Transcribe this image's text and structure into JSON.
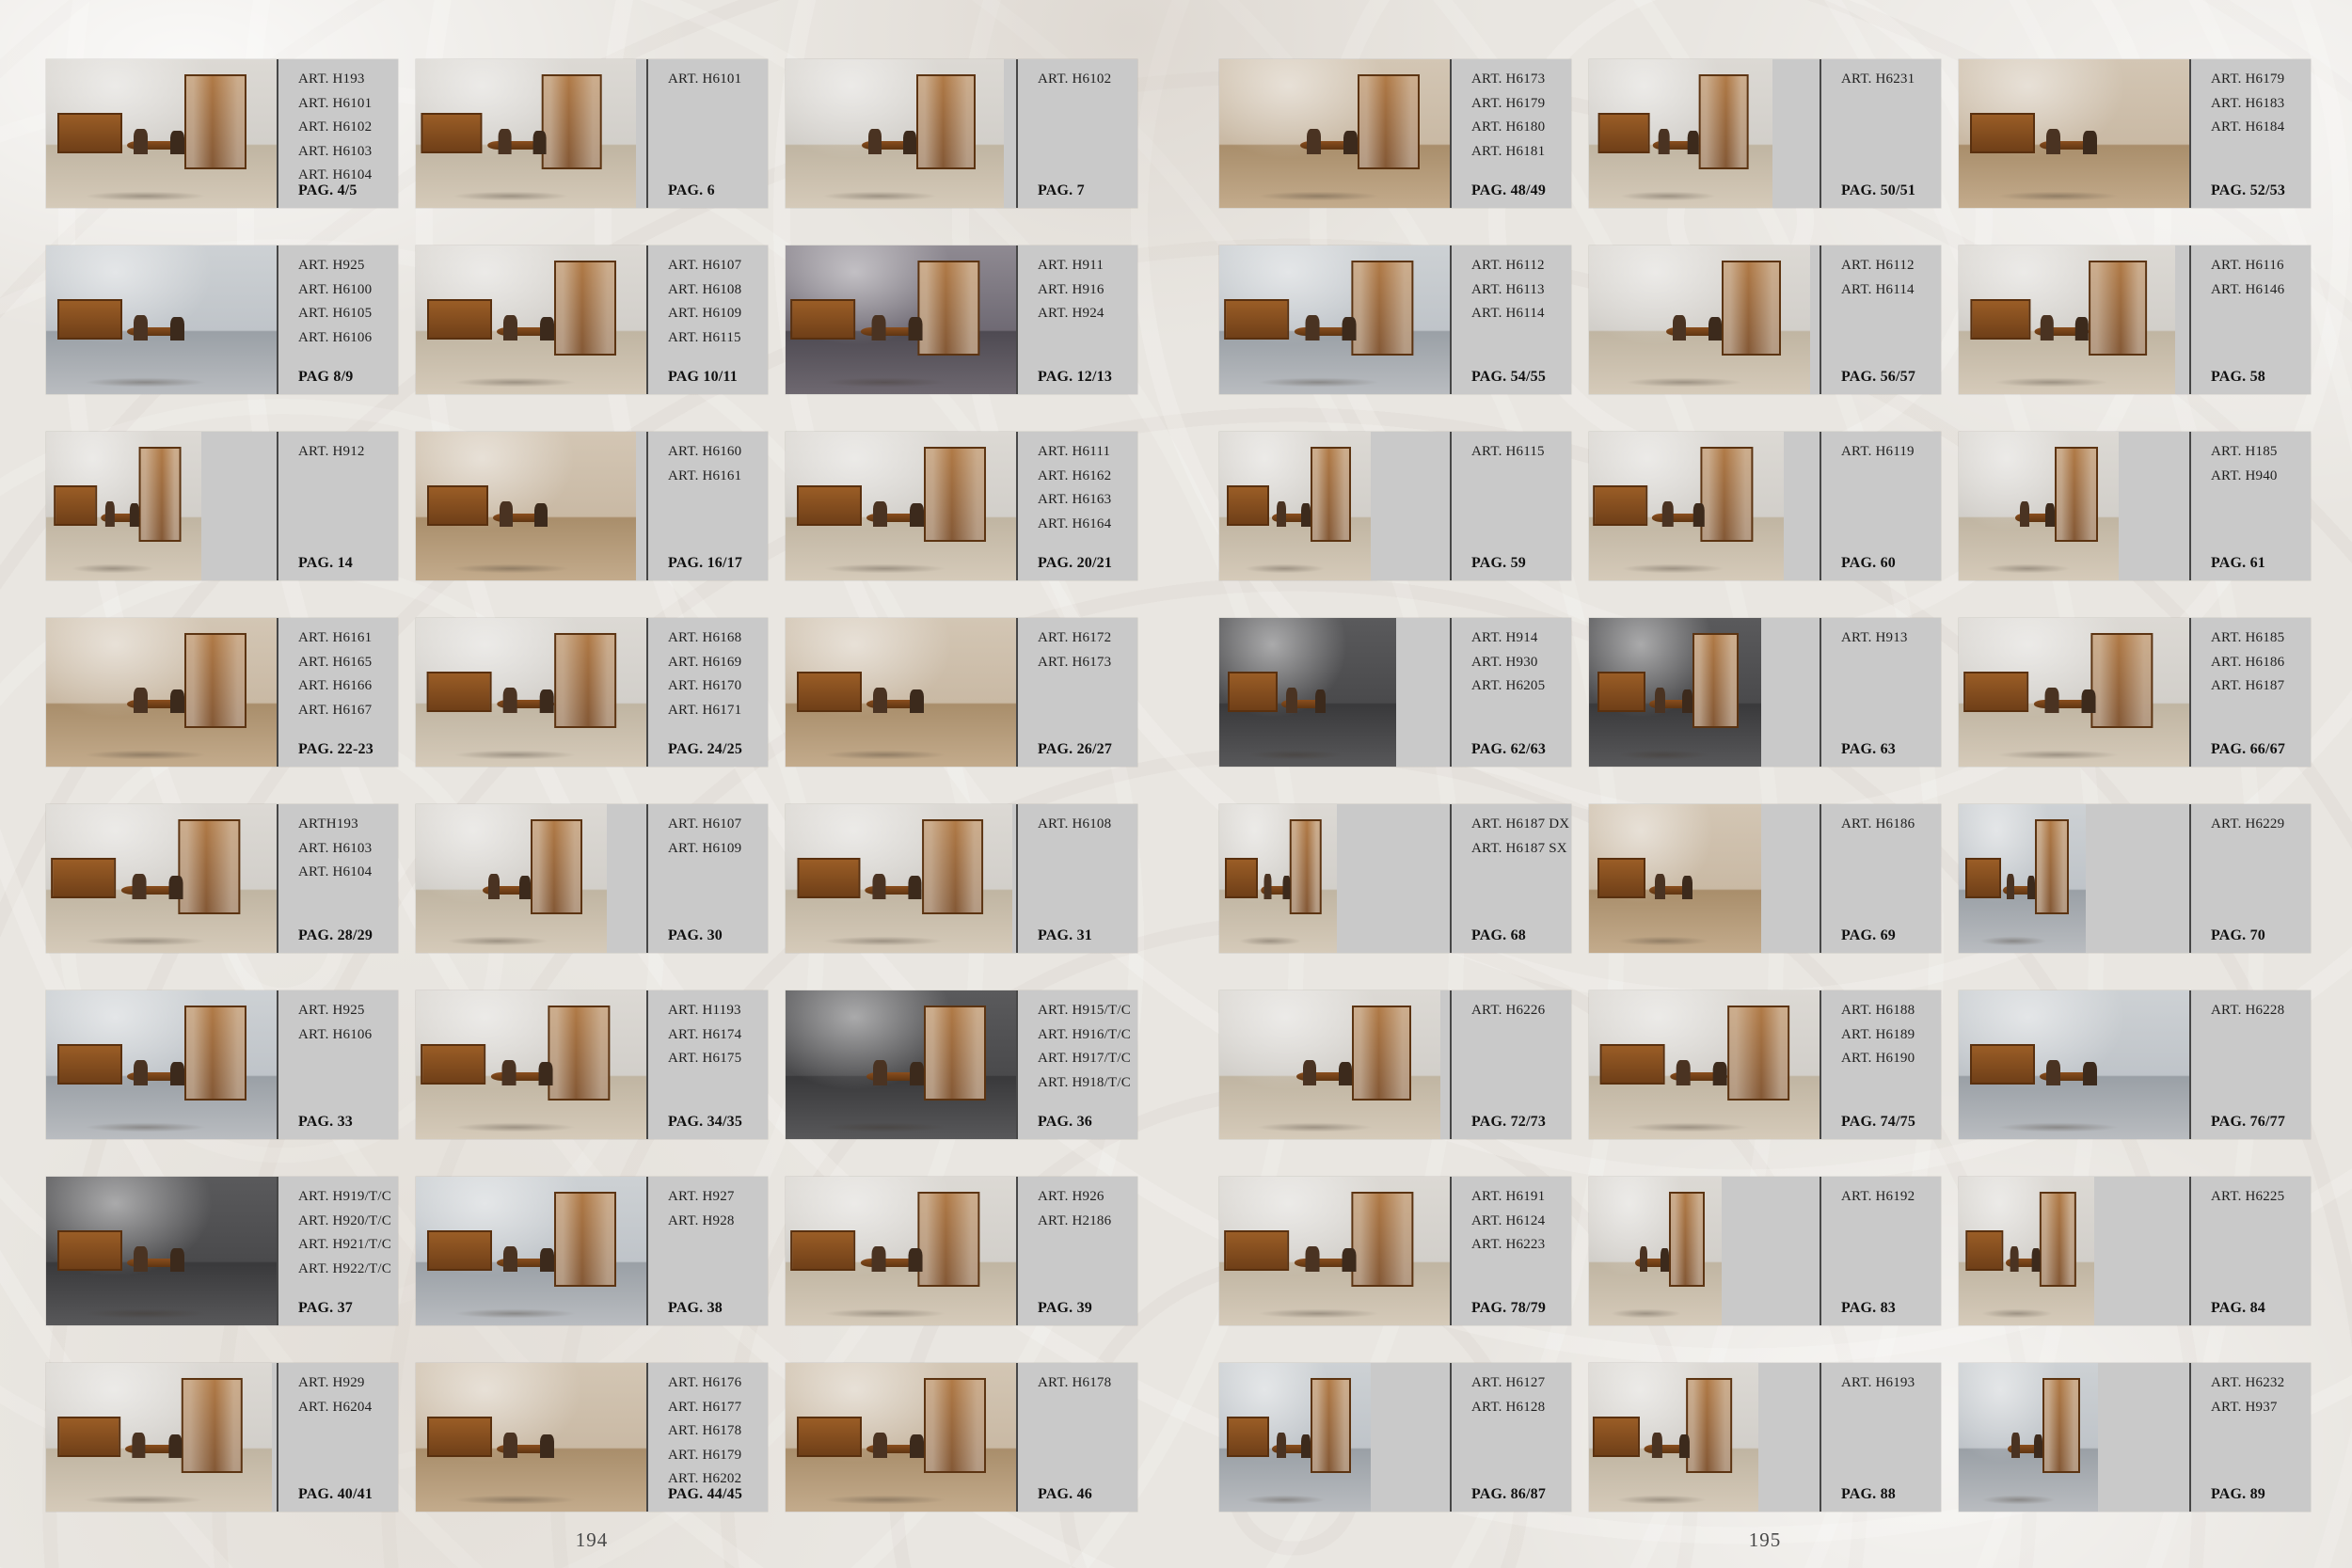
{
  "colors": {
    "background": "#e9e6e1",
    "panel_gray": "#c9c9c9",
    "divider": "#474747",
    "text": "#1f1f1f",
    "wood_accent": "#9a5d26"
  },
  "pages": [
    {
      "number": "194",
      "rows": [
        {
          "cells": [
            {
              "arts": [
                "ART. H193",
                "ART. H6101",
                "ART. H6102",
                "ART. H6103",
                "ART. H6104"
              ],
              "pag": "PAG. 4/5"
            },
            {
              "arts": [
                "ART. H6101"
              ],
              "pag": "PAG. 6"
            },
            {
              "arts": [
                "ART. H6102"
              ],
              "pag": "PAG. 7"
            }
          ]
        },
        {
          "cells": [
            {
              "arts": [
                "ART. H925",
                "ART. H6100",
                "ART. H6105",
                "ART. H6106"
              ],
              "pag": "PAG 8/9"
            },
            {
              "arts": [
                "ART. H6107",
                "ART. H6108",
                "ART. H6109",
                "ART. H6115"
              ],
              "pag": "PAG 10/11"
            },
            {
              "arts": [
                "ART. H911",
                "ART. H916",
                "ART. H924"
              ],
              "pag": "PAG. 12/13"
            }
          ]
        },
        {
          "cells": [
            {
              "arts": [
                "ART. H912"
              ],
              "pag": "PAG. 14"
            },
            {
              "arts": [
                "ART. H6160",
                "ART. H6161"
              ],
              "pag": "PAG. 16/17"
            },
            {
              "arts": [
                "ART. H6111",
                "ART. H6162",
                "ART. H6163",
                "ART. H6164"
              ],
              "pag": "PAG. 20/21"
            }
          ]
        },
        {
          "cells": [
            {
              "arts": [
                "ART. H6161",
                "ART. H6165",
                "ART. H6166",
                "ART. H6167"
              ],
              "pag": "PAG. 22-23"
            },
            {
              "arts": [
                "ART. H6168",
                "ART. H6169",
                "ART. H6170",
                "ART. H6171"
              ],
              "pag": "PAG. 24/25"
            },
            {
              "arts": [
                "ART. H6172",
                "ART. H6173"
              ],
              "pag": "PAG. 26/27"
            }
          ]
        },
        {
          "cells": [
            {
              "arts": [
                "ARTH193",
                "ART. H6103",
                "ART. H6104"
              ],
              "pag": "PAG. 28/29"
            },
            {
              "arts": [
                "ART. H6107",
                "ART. H6109"
              ],
              "pag": "PAG. 30"
            },
            {
              "arts": [
                "ART. H6108"
              ],
              "pag": "PAG. 31"
            }
          ]
        },
        {
          "cells": [
            {
              "arts": [
                "ART. H925",
                "ART. H6106"
              ],
              "pag": "PAG. 33"
            },
            {
              "arts": [
                "ART. H1193",
                "ART. H6174",
                "ART. H6175"
              ],
              "pag": "PAG. 34/35"
            },
            {
              "arts": [
                "ART. H915/T/C",
                "ART. H916/T/C",
                "ART. H917/T/C",
                "ART. H918/T/C"
              ],
              "pag": "PAG. 36"
            }
          ]
        },
        {
          "cells": [
            {
              "arts": [
                "ART. H919/T/C",
                "ART. H920/T/C",
                "ART. H921/T/C",
                "ART. H922/T/C"
              ],
              "pag": "PAG. 37"
            },
            {
              "arts": [
                "ART. H927",
                "ART. H928"
              ],
              "pag": "PAG. 38"
            },
            {
              "arts": [
                "ART. H926",
                "ART. H2186"
              ],
              "pag": "PAG. 39"
            }
          ]
        },
        {
          "cells": [
            {
              "arts": [
                "ART. H929",
                "ART. H6204"
              ],
              "pag": "PAG. 40/41"
            },
            {
              "arts": [
                "ART. H6176",
                "ART. H6177",
                "ART. H6178",
                "ART. H6179",
                "ART. H6202"
              ],
              "pag": "PAG. 44/45"
            },
            {
              "arts": [
                "ART. H6178"
              ],
              "pag": "PAG. 46"
            }
          ]
        }
      ]
    },
    {
      "number": "195",
      "rows": [
        {
          "cells": [
            {
              "arts": [
                "ART. H6173",
                "ART. H6179",
                "ART. H6180",
                "ART. H6181"
              ],
              "pag": "PAG. 48/49"
            },
            {
              "arts": [
                "ART. H6231"
              ],
              "pag": "PAG. 50/51"
            },
            {
              "arts": [
                "ART. H6179",
                "ART. H6183",
                "ART. H6184"
              ],
              "pag": "PAG. 52/53"
            }
          ]
        },
        {
          "cells": [
            {
              "arts": [
                "ART. H6112",
                "ART. H6113",
                "ART. H6114"
              ],
              "pag": "PAG. 54/55"
            },
            {
              "arts": [
                "ART. H6112",
                "ART. H6114"
              ],
              "pag": "PAG. 56/57"
            },
            {
              "arts": [
                "ART. H6116",
                "ART. H6146"
              ],
              "pag": "PAG. 58"
            }
          ]
        },
        {
          "cells": [
            {
              "arts": [
                "ART. H6115"
              ],
              "pag": "PAG. 59"
            },
            {
              "arts": [
                "ART. H6119"
              ],
              "pag": "PAG. 60"
            },
            {
              "arts": [
                "ART. H185",
                "ART. H940"
              ],
              "pag": "PAG. 61"
            }
          ]
        },
        {
          "cells": [
            {
              "arts": [
                "ART. H914",
                "ART. H930",
                "ART. H6205"
              ],
              "pag": "PAG. 62/63"
            },
            {
              "arts": [
                "ART. H913"
              ],
              "pag": "PAG. 63"
            },
            {
              "arts": [
                "ART. H6185",
                "ART. H6186",
                "ART. H6187"
              ],
              "pag": "PAG. 66/67"
            }
          ]
        },
        {
          "cells": [
            {
              "arts": [
                "ART. H6187 DX",
                "ART. H6187 SX"
              ],
              "pag": "PAG. 68"
            },
            {
              "arts": [
                "ART. H6186"
              ],
              "pag": "PAG. 69"
            },
            {
              "arts": [
                "ART. H6229"
              ],
              "pag": "PAG. 70"
            }
          ]
        },
        {
          "cells": [
            {
              "arts": [
                "ART. H6226"
              ],
              "pag": "PAG. 72/73"
            },
            {
              "arts": [
                "ART. H6188",
                "ART. H6189",
                "ART. H6190"
              ],
              "pag": "PAG. 74/75"
            },
            {
              "arts": [
                "ART. H6228"
              ],
              "pag": "PAG. 76/77"
            }
          ]
        },
        {
          "cells": [
            {
              "arts": [
                "ART. H6191",
                "ART. H6124",
                "ART. H6223"
              ],
              "pag": "PAG. 78/79"
            },
            {
              "arts": [
                "ART. H6192"
              ],
              "pag": "PAG. 83"
            },
            {
              "arts": [
                "ART. H6225"
              ],
              "pag": "PAG. 84"
            }
          ]
        },
        {
          "cells": [
            {
              "arts": [
                "ART. H6127",
                "ART. H6128"
              ],
              "pag": "PAG. 86/87"
            },
            {
              "arts": [
                "ART. H6193"
              ],
              "pag": "PAG. 88"
            },
            {
              "arts": [
                "ART. H6232",
                "ART. H937"
              ],
              "pag": "PAG. 89"
            }
          ]
        }
      ]
    }
  ]
}
